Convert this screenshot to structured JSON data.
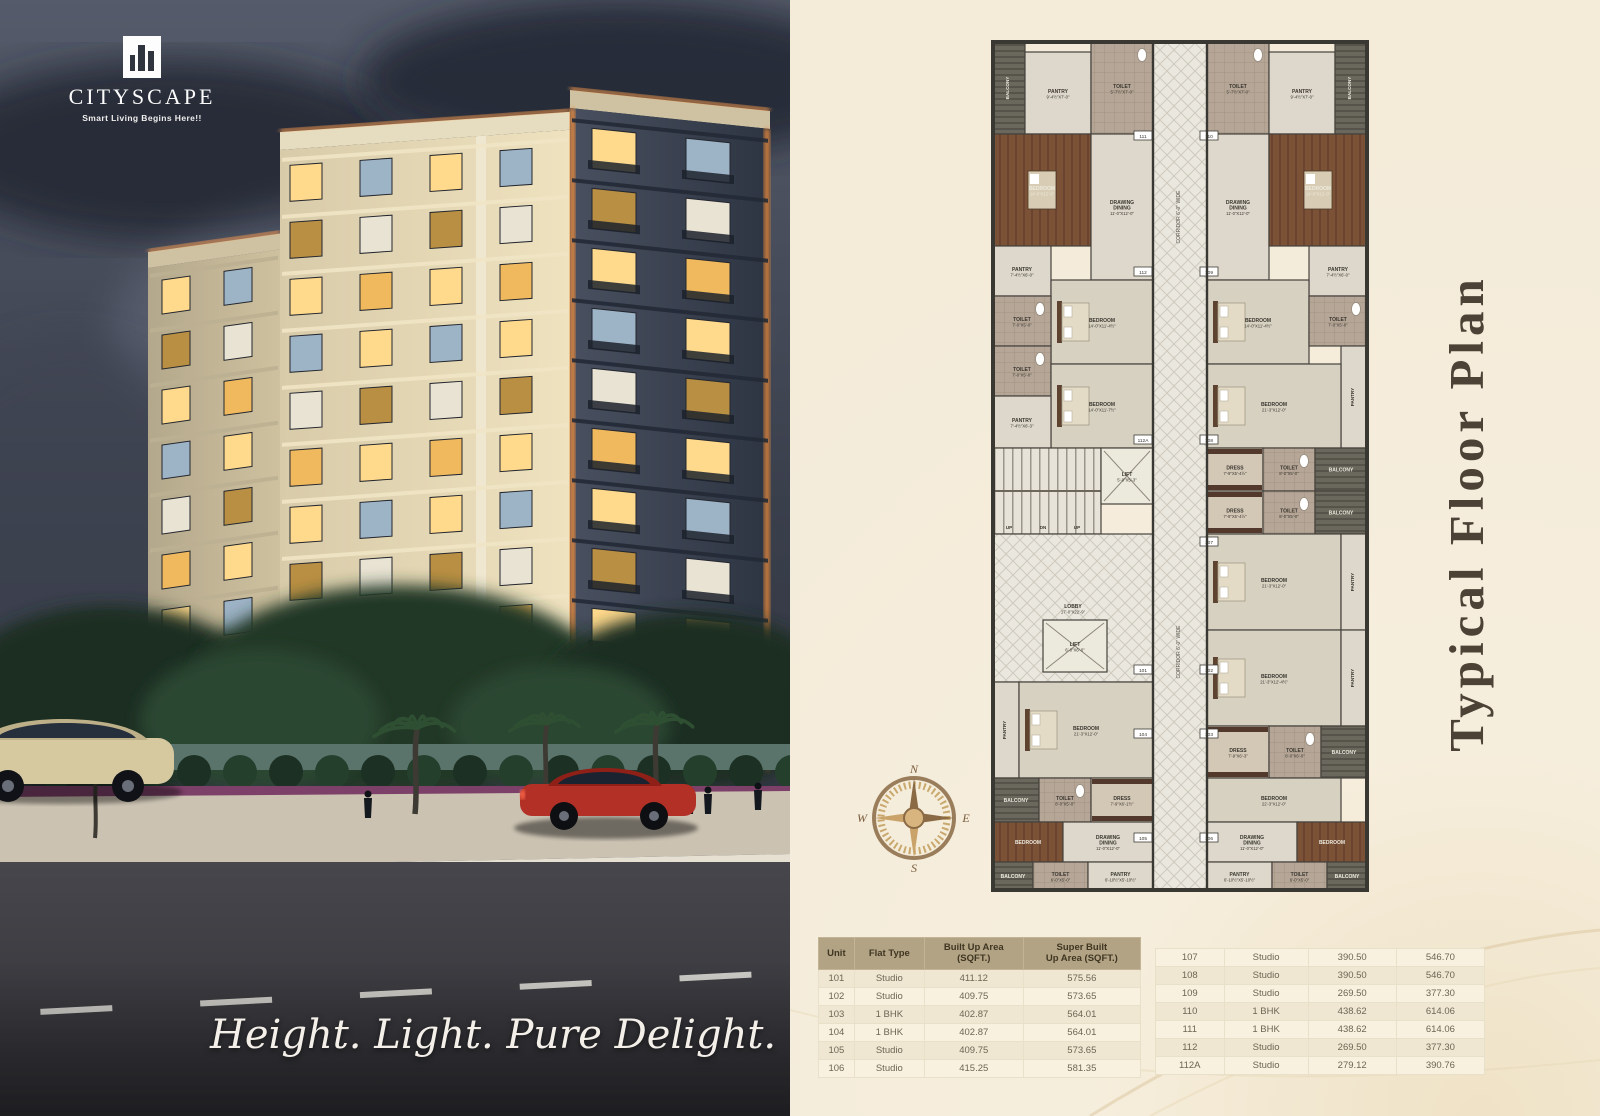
{
  "brand": {
    "name": "CITYSCAPE",
    "tagline": "Smart Living Begins Here!!"
  },
  "hero": {
    "slogan": "Height. Light. Pure Delight."
  },
  "plan": {
    "title": "Typical Floor Plan",
    "corridor_label": "CORRIDOR 6'-0\" WIDE",
    "stairs_labels": [
      "UP",
      "DN",
      "UP"
    ],
    "compass": {
      "n": "N",
      "e": "E",
      "s": "S",
      "w": "W"
    },
    "rooms": [
      {
        "x": 168,
        "y": 20,
        "w": 54,
        "h": 848,
        "t": "corr",
        "l": "",
        "d": ""
      },
      {
        "x": 8,
        "y": 20,
        "w": 32,
        "h": 92,
        "t": "balc",
        "l": "BALCONY",
        "d": "9'-4½\"X3'-4½\""
      },
      {
        "x": 40,
        "y": 30,
        "w": 66,
        "h": 82,
        "t": "room",
        "l": "PANTRY",
        "d": "9'-4½\"X7'-0\""
      },
      {
        "x": 106,
        "y": 20,
        "w": 62,
        "h": 92,
        "t": "tile",
        "l": "TOILET",
        "d": "5'-7½\"X7'-0\""
      },
      {
        "x": 8,
        "y": 112,
        "w": 98,
        "h": 112,
        "t": "wood",
        "l": "BEDROOM",
        "d": "14'-0\"X12'-0\""
      },
      {
        "x": 106,
        "y": 112,
        "w": 62,
        "h": 146,
        "t": "room",
        "l": "DRAWING|DINING",
        "d": "11'-0\"X12'-0\""
      },
      {
        "x": 8,
        "y": 224,
        "w": 58,
        "h": 50,
        "t": "room",
        "l": "PANTRY",
        "d": "7'-4½\"X6'-0\""
      },
      {
        "x": 66,
        "y": 258,
        "w": 102,
        "h": 84,
        "t": "bed",
        "l": "BEDROOM",
        "d": "14'-0\"X11'-4½\""
      },
      {
        "x": 8,
        "y": 274,
        "w": 58,
        "h": 50,
        "t": "tile",
        "l": "TOILET",
        "d": "7'-0\"X5'-0\""
      },
      {
        "x": 8,
        "y": 324,
        "w": 58,
        "h": 50,
        "t": "tile",
        "l": "TOILET",
        "d": "7'-0\"X5'-0\""
      },
      {
        "x": 66,
        "y": 342,
        "w": 102,
        "h": 84,
        "t": "bed",
        "l": "BEDROOM",
        "d": "14'-0\"X11'-7½\""
      },
      {
        "x": 8,
        "y": 374,
        "w": 58,
        "h": 52,
        "t": "room",
        "l": "PANTRY",
        "d": "7'-4½\"X6'-3\""
      },
      {
        "x": 8,
        "y": 426,
        "w": 108,
        "h": 86,
        "t": "stair",
        "l": "",
        "d": ""
      },
      {
        "x": 116,
        "y": 426,
        "w": 52,
        "h": 56,
        "t": "lift",
        "l": "LIFT",
        "d": "5'-0\"X5'-3\""
      },
      {
        "x": 8,
        "y": 512,
        "w": 160,
        "h": 148,
        "t": "lobby",
        "l": "LOBBY",
        "d": "17'-0\"X22'-9\""
      },
      {
        "x": 58,
        "y": 598,
        "w": 64,
        "h": 52,
        "t": "lift",
        "l": "LIFT",
        "d": "6'-0\"X6'-0\""
      },
      {
        "x": 8,
        "y": 660,
        "w": 26,
        "h": 96,
        "t": "vroom",
        "l": "PANTRY",
        "d": ""
      },
      {
        "x": 34,
        "y": 660,
        "w": 134,
        "h": 96,
        "t": "bed",
        "l": "BEDROOM",
        "d": "21'-3\"X12'-0\""
      },
      {
        "x": 8,
        "y": 756,
        "w": 46,
        "h": 44,
        "t": "balc",
        "l": "BALCONY",
        "d": ""
      },
      {
        "x": 54,
        "y": 756,
        "w": 52,
        "h": 44,
        "t": "tile",
        "l": "TOILET",
        "d": "8'-0\"X5'-0\""
      },
      {
        "x": 106,
        "y": 756,
        "w": 62,
        "h": 44,
        "t": "dress",
        "l": "DRESS",
        "d": "7'-9\"X6'-1½\""
      },
      {
        "x": 8,
        "y": 800,
        "w": 70,
        "h": 40,
        "t": "wood",
        "l": "BEDROOM",
        "d": ""
      },
      {
        "x": 78,
        "y": 800,
        "w": 90,
        "h": 40,
        "t": "room",
        "l": "DRAWING|DINING",
        "d": "11'-0\"X12'-0\""
      },
      {
        "x": 8,
        "y": 840,
        "w": 40,
        "h": 28,
        "t": "balc",
        "l": "BALCONY",
        "d": ""
      },
      {
        "x": 48,
        "y": 840,
        "w": 55,
        "h": 28,
        "t": "tile",
        "l": "TOILET",
        "d": "6'-0\"X5'-0\""
      },
      {
        "x": 103,
        "y": 840,
        "w": 65,
        "h": 28,
        "t": "room",
        "l": "PANTRY",
        "d": "6'-10½\"X5'-10½\""
      },
      {
        "x": 222,
        "y": 20,
        "w": 62,
        "h": 92,
        "t": "tile",
        "l": "TOILET",
        "d": "5'-7½\"X7'-0\""
      },
      {
        "x": 284,
        "y": 30,
        "w": 66,
        "h": 82,
        "t": "room",
        "l": "PANTRY",
        "d": "9'-4½\"X7'-0\""
      },
      {
        "x": 350,
        "y": 20,
        "w": 32,
        "h": 92,
        "t": "balc",
        "l": "BALCONY",
        "d": "9'-4½\"X3'-4½\""
      },
      {
        "x": 222,
        "y": 112,
        "w": 62,
        "h": 146,
        "t": "room",
        "l": "DRAWING|DINING",
        "d": "11'-0\"X12'-0\""
      },
      {
        "x": 284,
        "y": 112,
        "w": 98,
        "h": 112,
        "t": "wood",
        "l": "BEDROOM",
        "d": "14'-0\"X12'-0\""
      },
      {
        "x": 324,
        "y": 224,
        "w": 58,
        "h": 50,
        "t": "room",
        "l": "PANTRY",
        "d": "7'-4½\"X6'-0\""
      },
      {
        "x": 222,
        "y": 258,
        "w": 102,
        "h": 84,
        "t": "bed",
        "l": "BEDROOM",
        "d": "14'-0\"X11'-4½\""
      },
      {
        "x": 324,
        "y": 274,
        "w": 58,
        "h": 50,
        "t": "tile",
        "l": "TOILET",
        "d": "7'-0\"X5'-0\""
      },
      {
        "x": 356,
        "y": 324,
        "w": 26,
        "h": 102,
        "t": "vroom",
        "l": "PANTRY",
        "d": ""
      },
      {
        "x": 222,
        "y": 342,
        "w": 134,
        "h": 84,
        "t": "bed",
        "l": "BEDROOM",
        "d": "21'-3\"X12'-0\""
      },
      {
        "x": 222,
        "y": 426,
        "w": 56,
        "h": 43,
        "t": "dress",
        "l": "DRESS",
        "d": "7'-9\"X5'-4½\""
      },
      {
        "x": 278,
        "y": 426,
        "w": 52,
        "h": 43,
        "t": "tile",
        "l": "TOILET",
        "d": "8'-0\"X5'-0\""
      },
      {
        "x": 330,
        "y": 426,
        "w": 52,
        "h": 43,
        "t": "balc",
        "l": "BALCONY",
        "d": ""
      },
      {
        "x": 222,
        "y": 469,
        "w": 56,
        "h": 43,
        "t": "dress",
        "l": "DRESS",
        "d": "7'-9\"X5'-4½\""
      },
      {
        "x": 278,
        "y": 469,
        "w": 52,
        "h": 43,
        "t": "tile",
        "l": "TOILET",
        "d": "8'-0\"X5'-0\""
      },
      {
        "x": 330,
        "y": 469,
        "w": 52,
        "h": 43,
        "t": "balc",
        "l": "BALCONY",
        "d": ""
      },
      {
        "x": 222,
        "y": 512,
        "w": 134,
        "h": 96,
        "t": "bed",
        "l": "BEDROOM",
        "d": "21'-3\"X12'-0\""
      },
      {
        "x": 356,
        "y": 512,
        "w": 26,
        "h": 96,
        "t": "vroom",
        "l": "PANTRY",
        "d": ""
      },
      {
        "x": 222,
        "y": 608,
        "w": 134,
        "h": 96,
        "t": "bed",
        "l": "BEDROOM",
        "d": "21'-3\"X12'-4½\""
      },
      {
        "x": 356,
        "y": 608,
        "w": 26,
        "h": 96,
        "t": "vroom",
        "l": "PANTRY",
        "d": ""
      },
      {
        "x": 222,
        "y": 704,
        "w": 62,
        "h": 52,
        "t": "dress",
        "l": "DRESS",
        "d": "7'-9\"X6'-3\""
      },
      {
        "x": 284,
        "y": 704,
        "w": 52,
        "h": 52,
        "t": "tile",
        "l": "TOILET",
        "d": "8'-0\"X6'-0\""
      },
      {
        "x": 336,
        "y": 704,
        "w": 46,
        "h": 52,
        "t": "balc",
        "l": "BALCONY",
        "d": ""
      },
      {
        "x": 222,
        "y": 756,
        "w": 134,
        "h": 44,
        "t": "bed",
        "l": "BEDROOM",
        "d": "22'-3\"X12'-0\""
      },
      {
        "x": 222,
        "y": 800,
        "w": 90,
        "h": 40,
        "t": "room",
        "l": "DRAWING|DINING",
        "d": "11'-0\"X12'-0\""
      },
      {
        "x": 312,
        "y": 800,
        "w": 70,
        "h": 40,
        "t": "wood",
        "l": "BEDROOM",
        "d": ""
      },
      {
        "x": 222,
        "y": 840,
        "w": 65,
        "h": 28,
        "t": "room",
        "l": "PANTRY",
        "d": "6'-10½\"X5'-10½\""
      },
      {
        "x": 287,
        "y": 840,
        "w": 55,
        "h": 28,
        "t": "tile",
        "l": "TOILET",
        "d": "6'-0\"X5'-0\""
      },
      {
        "x": 342,
        "y": 840,
        "w": 40,
        "h": 28,
        "t": "balc",
        "l": "BALCONY",
        "d": ""
      }
    ],
    "door_tags": [
      {
        "x": 158,
        "y": 114,
        "n": "111"
      },
      {
        "x": 224,
        "y": 114,
        "n": "110"
      },
      {
        "x": 158,
        "y": 250,
        "n": "112"
      },
      {
        "x": 224,
        "y": 250,
        "n": "109"
      },
      {
        "x": 158,
        "y": 418,
        "n": "112A"
      },
      {
        "x": 224,
        "y": 418,
        "n": "108"
      },
      {
        "x": 224,
        "y": 520,
        "n": "107"
      },
      {
        "x": 158,
        "y": 648,
        "n": "101"
      },
      {
        "x": 224,
        "y": 648,
        "n": "102"
      },
      {
        "x": 158,
        "y": 712,
        "n": "104"
      },
      {
        "x": 224,
        "y": 712,
        "n": "103"
      },
      {
        "x": 158,
        "y": 816,
        "n": "105"
      },
      {
        "x": 224,
        "y": 816,
        "n": "106"
      }
    ]
  },
  "tables": {
    "left": {
      "headers": [
        "Unit",
        "Flat Type",
        "Built Up Area\n(SQFT.)",
        "Super Built\nUp Area (SQFT.)"
      ],
      "rows": [
        [
          "101",
          "Studio",
          "411.12",
          "575.56"
        ],
        [
          "102",
          "Studio",
          "409.75",
          "573.65"
        ],
        [
          "103",
          "1 BHK",
          "402.87",
          "564.01"
        ],
        [
          "104",
          "1 BHK",
          "402.87",
          "564.01"
        ],
        [
          "105",
          "Studio",
          "409.75",
          "573.65"
        ],
        [
          "106",
          "Studio",
          "415.25",
          "581.35"
        ]
      ]
    },
    "right": {
      "rows": [
        [
          "107",
          "Studio",
          "390.50",
          "546.70"
        ],
        [
          "108",
          "Studio",
          "390.50",
          "546.70"
        ],
        [
          "109",
          "Studio",
          "269.50",
          "377.30"
        ],
        [
          "110",
          "1 BHK",
          "438.62",
          "614.06"
        ],
        [
          "111",
          "1 BHK",
          "438.62",
          "614.06"
        ],
        [
          "112",
          "Studio",
          "269.50",
          "377.30"
        ],
        [
          "112A",
          "Studio",
          "279.12",
          "390.76"
        ]
      ]
    }
  },
  "colors": {
    "accent_orange": "#e78a3e",
    "header_tan": "#b2a385",
    "panel_cream": "#f4ebd9"
  }
}
